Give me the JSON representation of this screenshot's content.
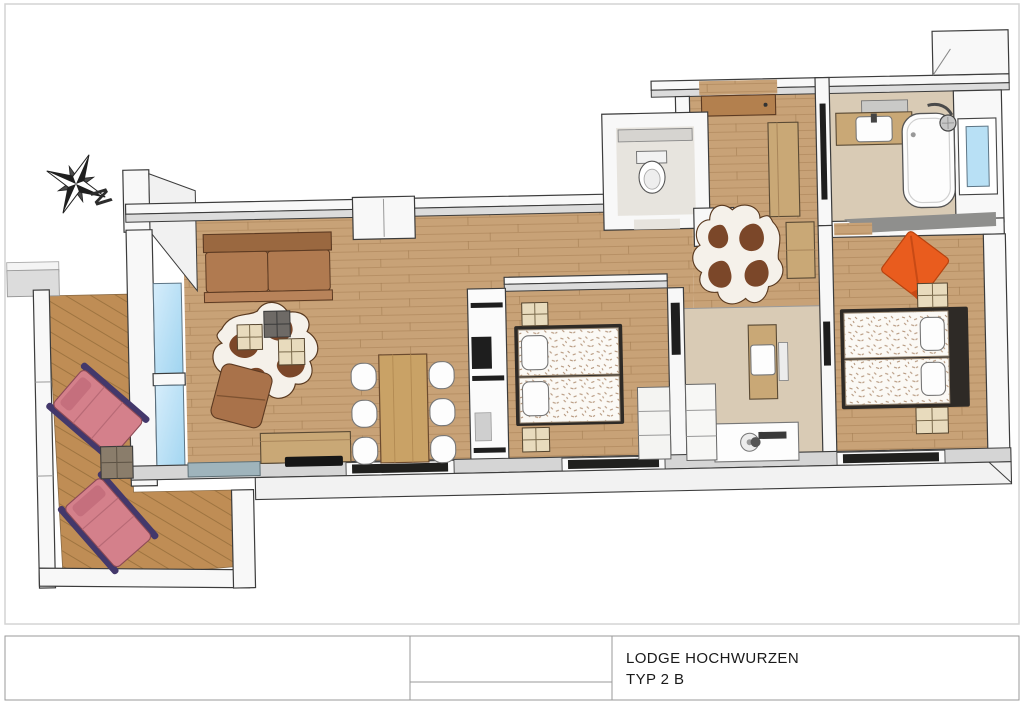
{
  "title_block": {
    "project": "LODGE HOCHWURZEN",
    "type": "TYP 2 B"
  },
  "compass": {
    "north": "N"
  },
  "colors": {
    "wood_floor": "#c8a277",
    "balcony_deck": "#bf8d55",
    "tile_beige": "#d9cbb5",
    "wc_floor": "#e7e4de",
    "wall_white": "#f8f8f8",
    "outline": "#3c3c3c",
    "glass_blue": "#b8e0f5",
    "sofa_brown": "#b07a50",
    "cowhide_brown": "#7b4729",
    "lounger_pink": "#d4808b",
    "lounger_frame": "#43386b",
    "cushion_orange": "#e95c1e",
    "furniture_tan": "#c9a876"
  }
}
